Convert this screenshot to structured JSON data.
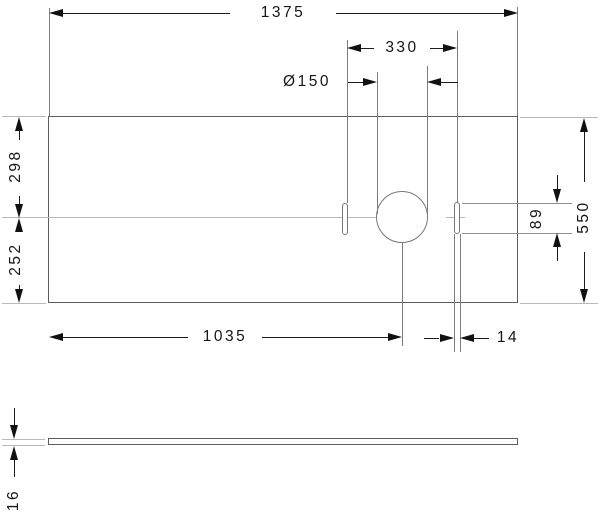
{
  "drawing": {
    "kind": "technical-dimension-drawing",
    "dimensions": {
      "total_width": "1375",
      "slot_spacing": "330",
      "hole_diameter": "Ø150",
      "rear_to_center_depth": "298",
      "center_to_front_depth": "252",
      "total_depth": "550",
      "slot_length": "89",
      "hole_center_from_left": "1035",
      "slot_width": "14",
      "plate_thickness": "16"
    }
  }
}
